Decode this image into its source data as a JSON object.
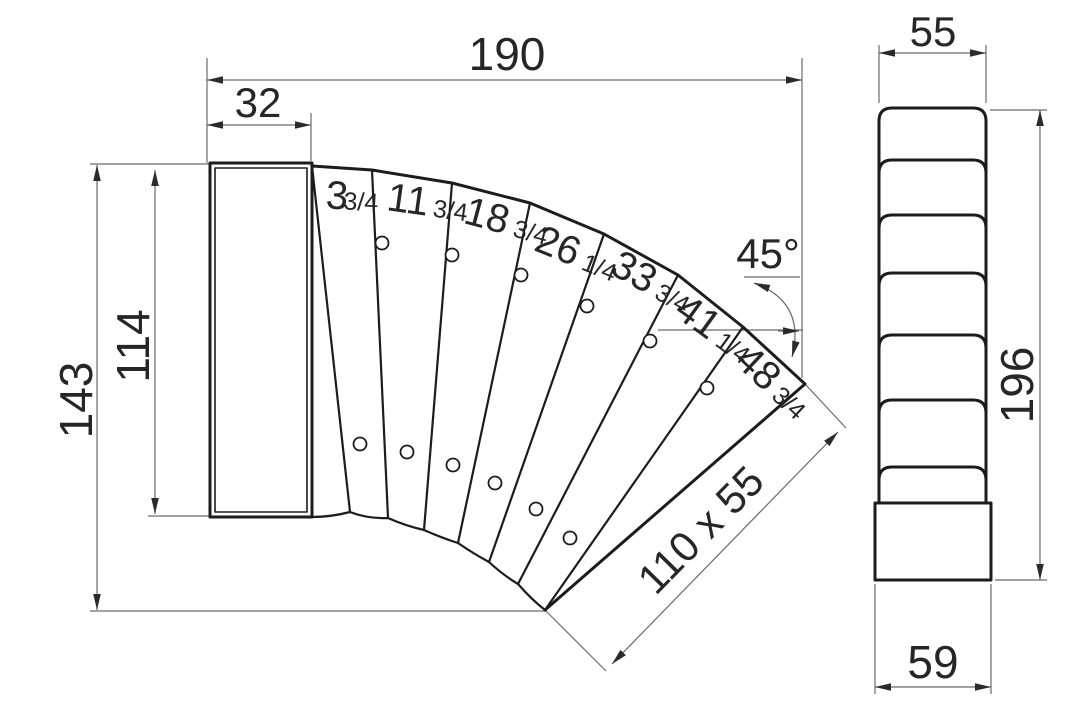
{
  "side_view": {
    "dims": {
      "total_length": "190",
      "sleeve_length": "32",
      "overall_height": "143",
      "sleeve_height": "114",
      "angle": "45°",
      "outlet_size": "110 x 55"
    },
    "segment_labels": [
      {
        "whole": "3",
        "fraction": "3/4"
      },
      {
        "whole": "11",
        "fraction": "3/4"
      },
      {
        "whole": "18",
        "fraction": "3/4"
      },
      {
        "whole": "26",
        "fraction": "1/4"
      },
      {
        "whole": "33",
        "fraction": "3/4"
      },
      {
        "whole": "41",
        "fraction": "1/4"
      },
      {
        "whole": "48",
        "fraction": "3/4"
      }
    ]
  },
  "front_view": {
    "dims": {
      "width_top": "55",
      "height": "196",
      "width_bottom": "59"
    }
  },
  "colors": {
    "object_line": "#1c1c1c",
    "dimension_line": "#6a6a6a",
    "text": "#262626",
    "background": "#ffffff"
  }
}
